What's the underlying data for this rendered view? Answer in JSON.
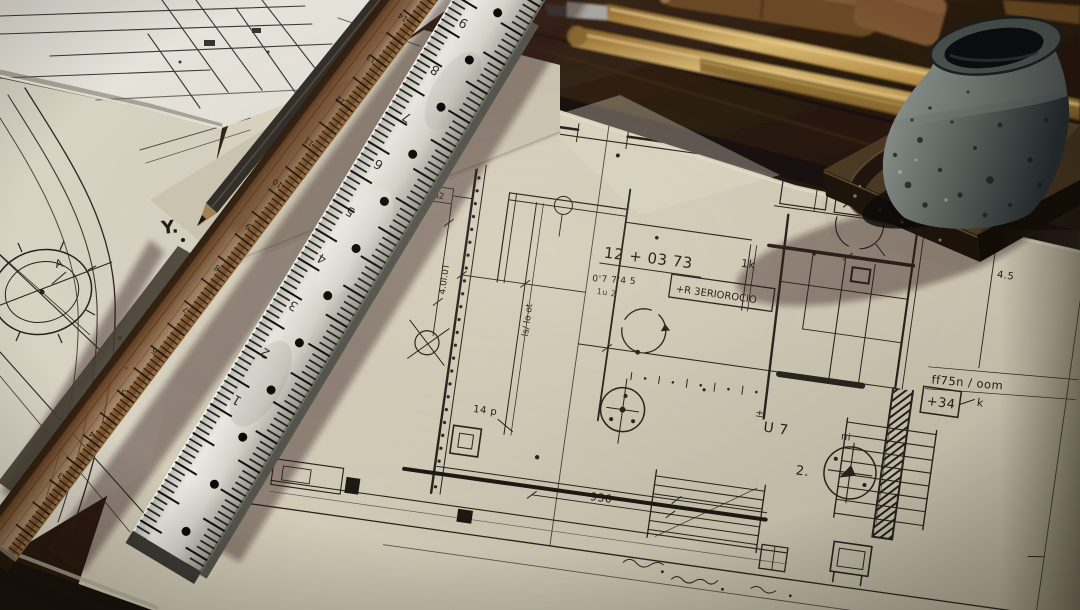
{
  "labels": {
    "dim_64": "64",
    "note_12_03_73": "12 + 03  73",
    "note_1k": "1k",
    "note_u7": "U 7",
    "note_pm": "±",
    "note_2": "2.",
    "note_plus34": "+34",
    "note_k": "k",
    "wall_note": "ff75n / oom",
    "part_label": "#9662",
    "box_note": "+R 3ERIOROCIO",
    "dim_930": "930",
    "note_14p": "14 p",
    "note_ni": "ni",
    "dim_vertical": "4.0l.0T",
    "dim_vertical2": "ls/ lo ot",
    "note_074": "0'7 7'4 5",
    "note_small": "1u 2",
    "note_45": "4.5"
  },
  "left_sheets": {
    "label_y": "Y.",
    "label_a": "A"
  },
  "steel_ruler": {
    "numbers": [
      "9",
      "8",
      "7",
      "6",
      "5",
      "4",
      "3",
      "2",
      "1"
    ]
  },
  "wood_ruler": {
    "numbers": [
      "14",
      "13",
      "12",
      "11",
      "10",
      "9",
      "8",
      "7",
      "6",
      "5",
      "4",
      "3"
    ]
  },
  "palette": {
    "paper": "#d7d0bd",
    "white_sheet": "#e6e3da",
    "ink": "#26221c",
    "steel": "#d8d7cf",
    "ruler_wood": "#6e4a2c",
    "brass": "#b98e4a",
    "inkwell_metal": "#6f7572",
    "table_wood": "#2a1c11"
  }
}
